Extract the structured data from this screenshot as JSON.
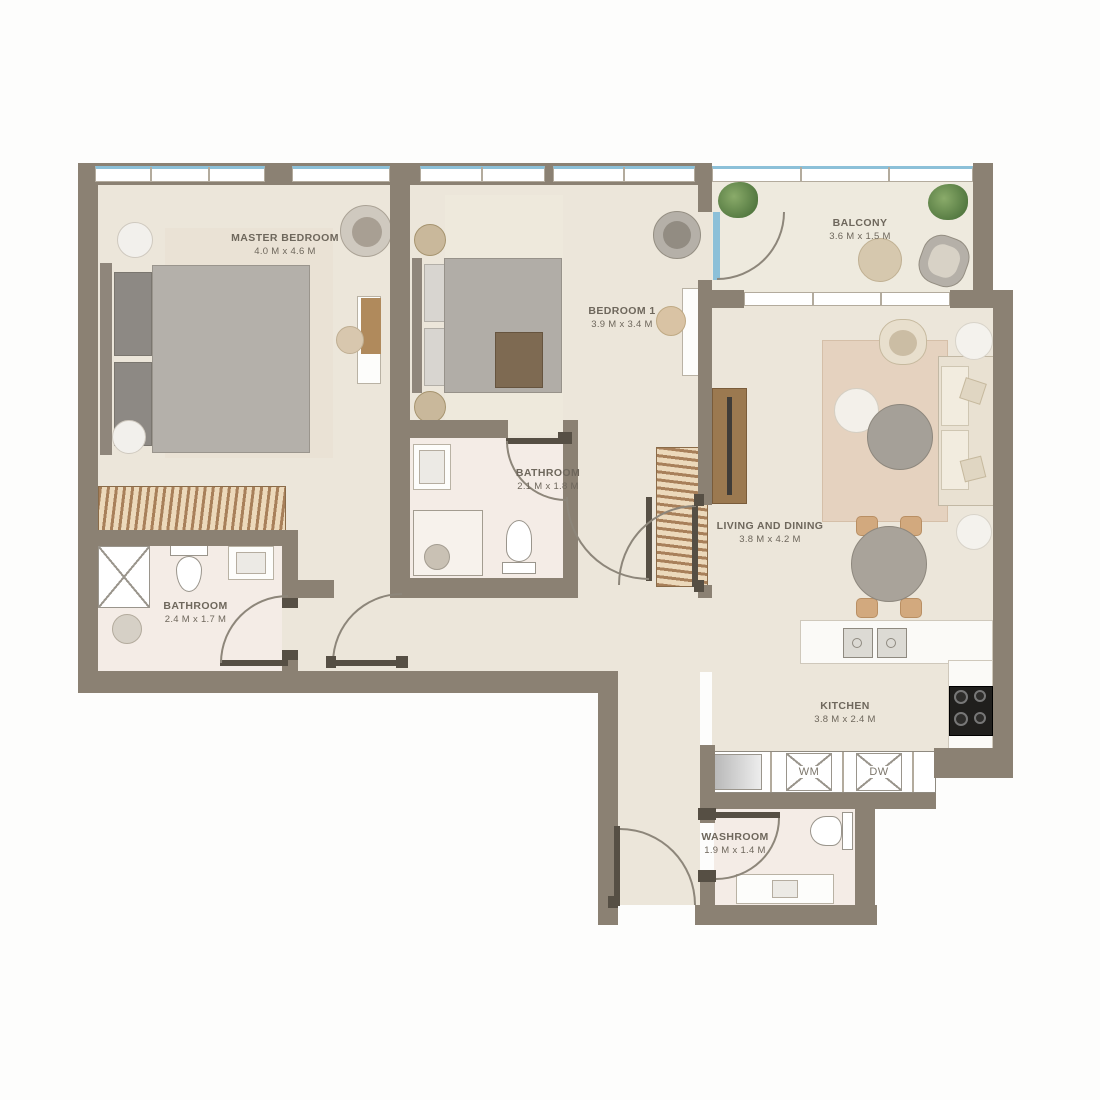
{
  "colors": {
    "wall": "#8b8173",
    "floor": "#ece6da",
    "bathroom_floor": "#f4ece6",
    "glass": "#8cc0d8",
    "wood_closet": "#a8805a"
  },
  "rooms": {
    "master_bedroom": {
      "name": "MASTER BEDROOM",
      "dims": "4.0 M x 4.6 M"
    },
    "bedroom_1": {
      "name": "BEDROOM 1",
      "dims": "3.9 M x 3.4 M"
    },
    "balcony": {
      "name": "BALCONY",
      "dims": "3.6 M x 1.5 M"
    },
    "master_bathroom": {
      "name": "BATHROOM",
      "dims": "2.4 M x 1.7 M"
    },
    "bathroom": {
      "name": "BATHROOM",
      "dims": "2.1 M x 1.8 M"
    },
    "living_dining": {
      "name": "LIVING AND DINING",
      "dims": "3.8 M x 4.2 M"
    },
    "kitchen": {
      "name": "KITCHEN",
      "dims": "3.8 M x 2.4 M"
    },
    "washroom": {
      "name": "WASHROOM",
      "dims": "1.9 M x 1.4 M"
    }
  },
  "appliances": {
    "washing_machine": "WM",
    "dishwasher": "DW"
  }
}
